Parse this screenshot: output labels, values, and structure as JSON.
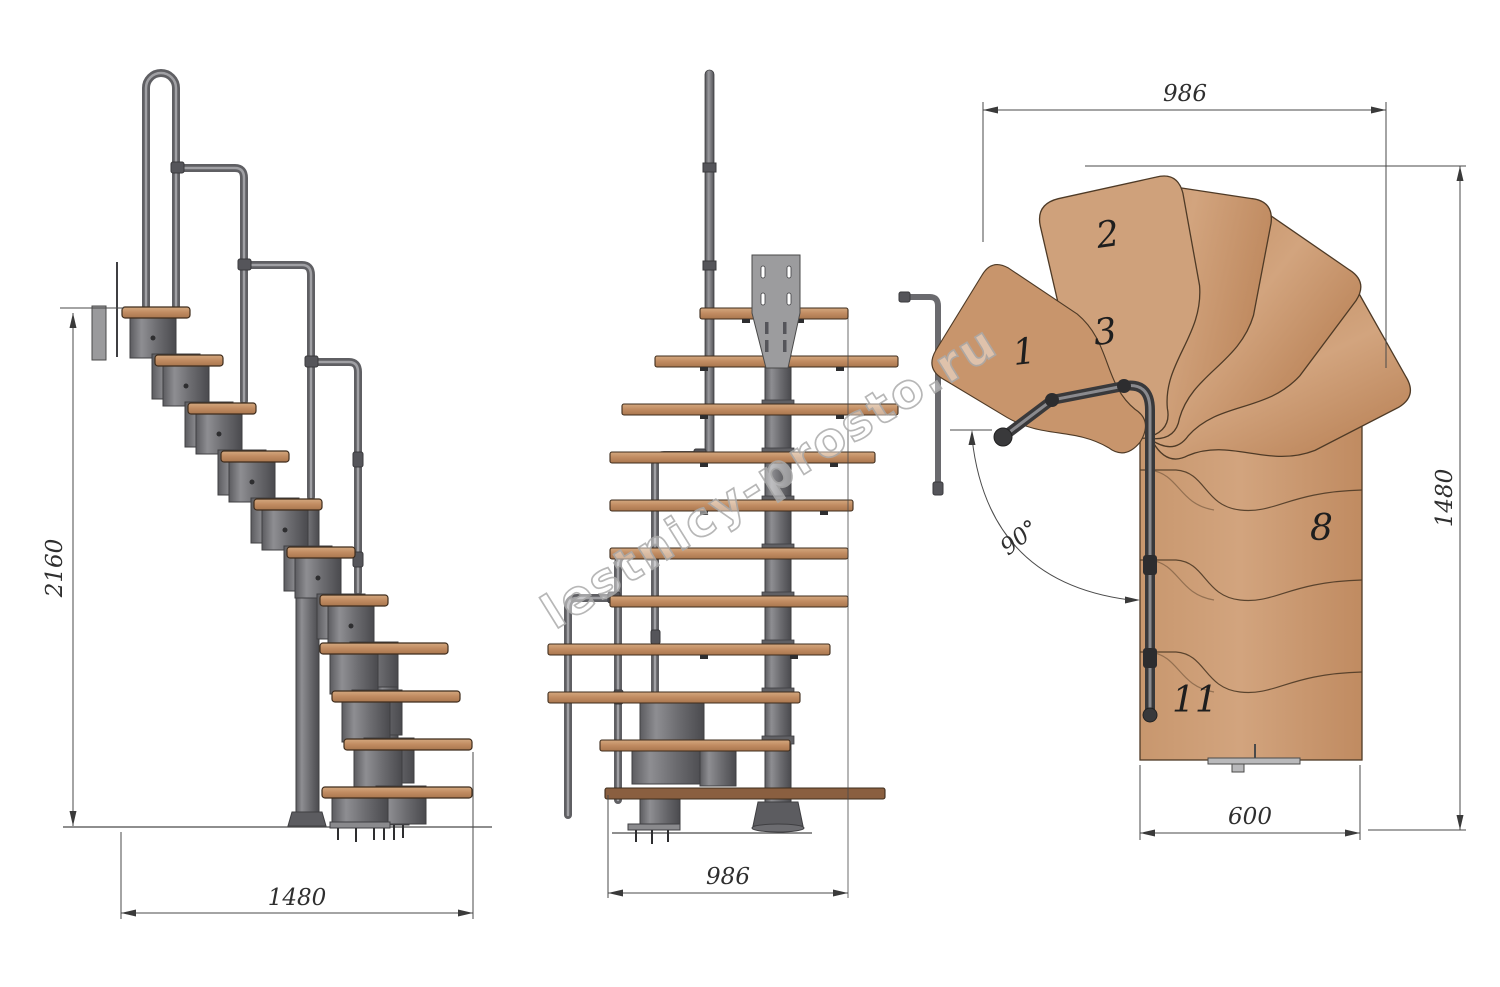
{
  "watermark": {
    "text": "lestnicy-prosto.ru"
  },
  "views": {
    "side_elevation": {
      "dims": {
        "height": "2160",
        "length": "1480"
      }
    },
    "front_elevation": {
      "dims": {
        "width": "986"
      }
    },
    "top_plan": {
      "dims": {
        "width_top": "986",
        "depth_right": "1480",
        "flight_width_bottom": "600",
        "turn_angle": "90°"
      },
      "tread_numbers": [
        "1",
        "2",
        "3",
        "8",
        "11"
      ]
    }
  },
  "colors": {
    "wood": "#c9986f",
    "wood_light": "#d2a47e",
    "wood_edge": "#4e3a26",
    "metal": "#7d7d80",
    "metal_dark": "#3f3f42",
    "tube": "#67676b",
    "dim_line": "#4a4a4a",
    "watermark_gray": "#ababab"
  }
}
